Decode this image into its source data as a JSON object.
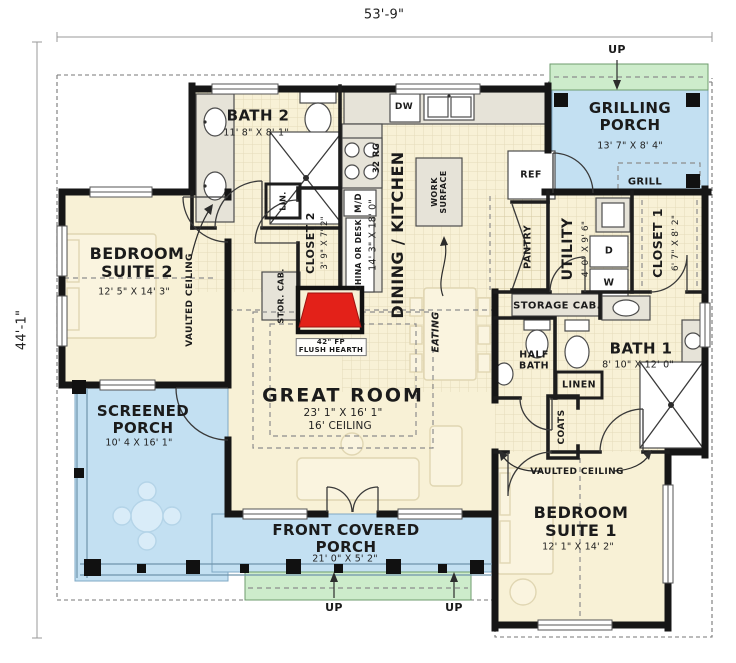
{
  "title": "House floor plan",
  "overall": {
    "width": "53'-9\"",
    "height": "44'-1\""
  },
  "labels": {
    "up": "UP"
  },
  "rooms": {
    "bath2": {
      "name": "BATH 2",
      "dims": "11' 8\" X 8' 1\""
    },
    "grilling_porch": {
      "name": "GRILLING PORCH",
      "dims": "13' 7\" X 8' 4\""
    },
    "dining_kitchen": {
      "name": "DINING / KITCHEN",
      "dims": "14' 3\" X 18' 0\""
    },
    "utility": {
      "name": "UTILITY",
      "dims": "4' 0\" X 9' 6\""
    },
    "closet1": {
      "name": "CLOSET 1",
      "dims": "6' 7\" X 8' 2\""
    },
    "closet2": {
      "name": "CLOSET 2",
      "dims": "3' 9\" X 7' 2\""
    },
    "bath1": {
      "name": "BATH 1",
      "dims": "8' 10\" X 12' 0\""
    },
    "half_bath": {
      "name": "HALF BATH"
    },
    "bedroom2": {
      "name": "BEDROOM SUITE 2",
      "dims": "12' 5\" X 14' 3\""
    },
    "bedroom1": {
      "name": "BEDROOM SUITE 1",
      "dims": "12' 1\" X 14' 2\""
    },
    "great_room": {
      "name": "GREAT ROOM",
      "dims": "23' 1\" X 16' 1\"",
      "ceiling": "16' CEILING"
    },
    "screened_porch": {
      "name": "SCREENED PORCH",
      "dims": "10' 4 X 16' 1\""
    },
    "front_porch": {
      "name": "FRONT COVERED PORCH",
      "dims": "21' 0\" X 5' 2\""
    }
  },
  "fixtures": {
    "dw": "DW",
    "range": "32 RG",
    "microwave": "M/D",
    "china": "CHINA OR DESK",
    "work_surface": "WORK SURFACE",
    "eating": "EATING",
    "ref": "REF",
    "pantry": "PANTRY",
    "storage_cab": "STORAGE CAB.",
    "stor_cab": "STOR. CAB.",
    "lin": "LIN.",
    "linen": "LINEN",
    "coats": "COATS",
    "grill": "GRILL",
    "dryer": "D",
    "washer": "W"
  },
  "annotations": {
    "vaulted_ceiling": "VAULTED CEILING",
    "fireplace": "42\" FP\nFLUSH HEARTH"
  },
  "colors": {
    "floor": "#f8f1d6",
    "porch": "#c3e0f2",
    "steps": "#cdeccb",
    "wall": "#161616",
    "fixture": "#e6e3d8",
    "fireplace": "#e32119"
  }
}
